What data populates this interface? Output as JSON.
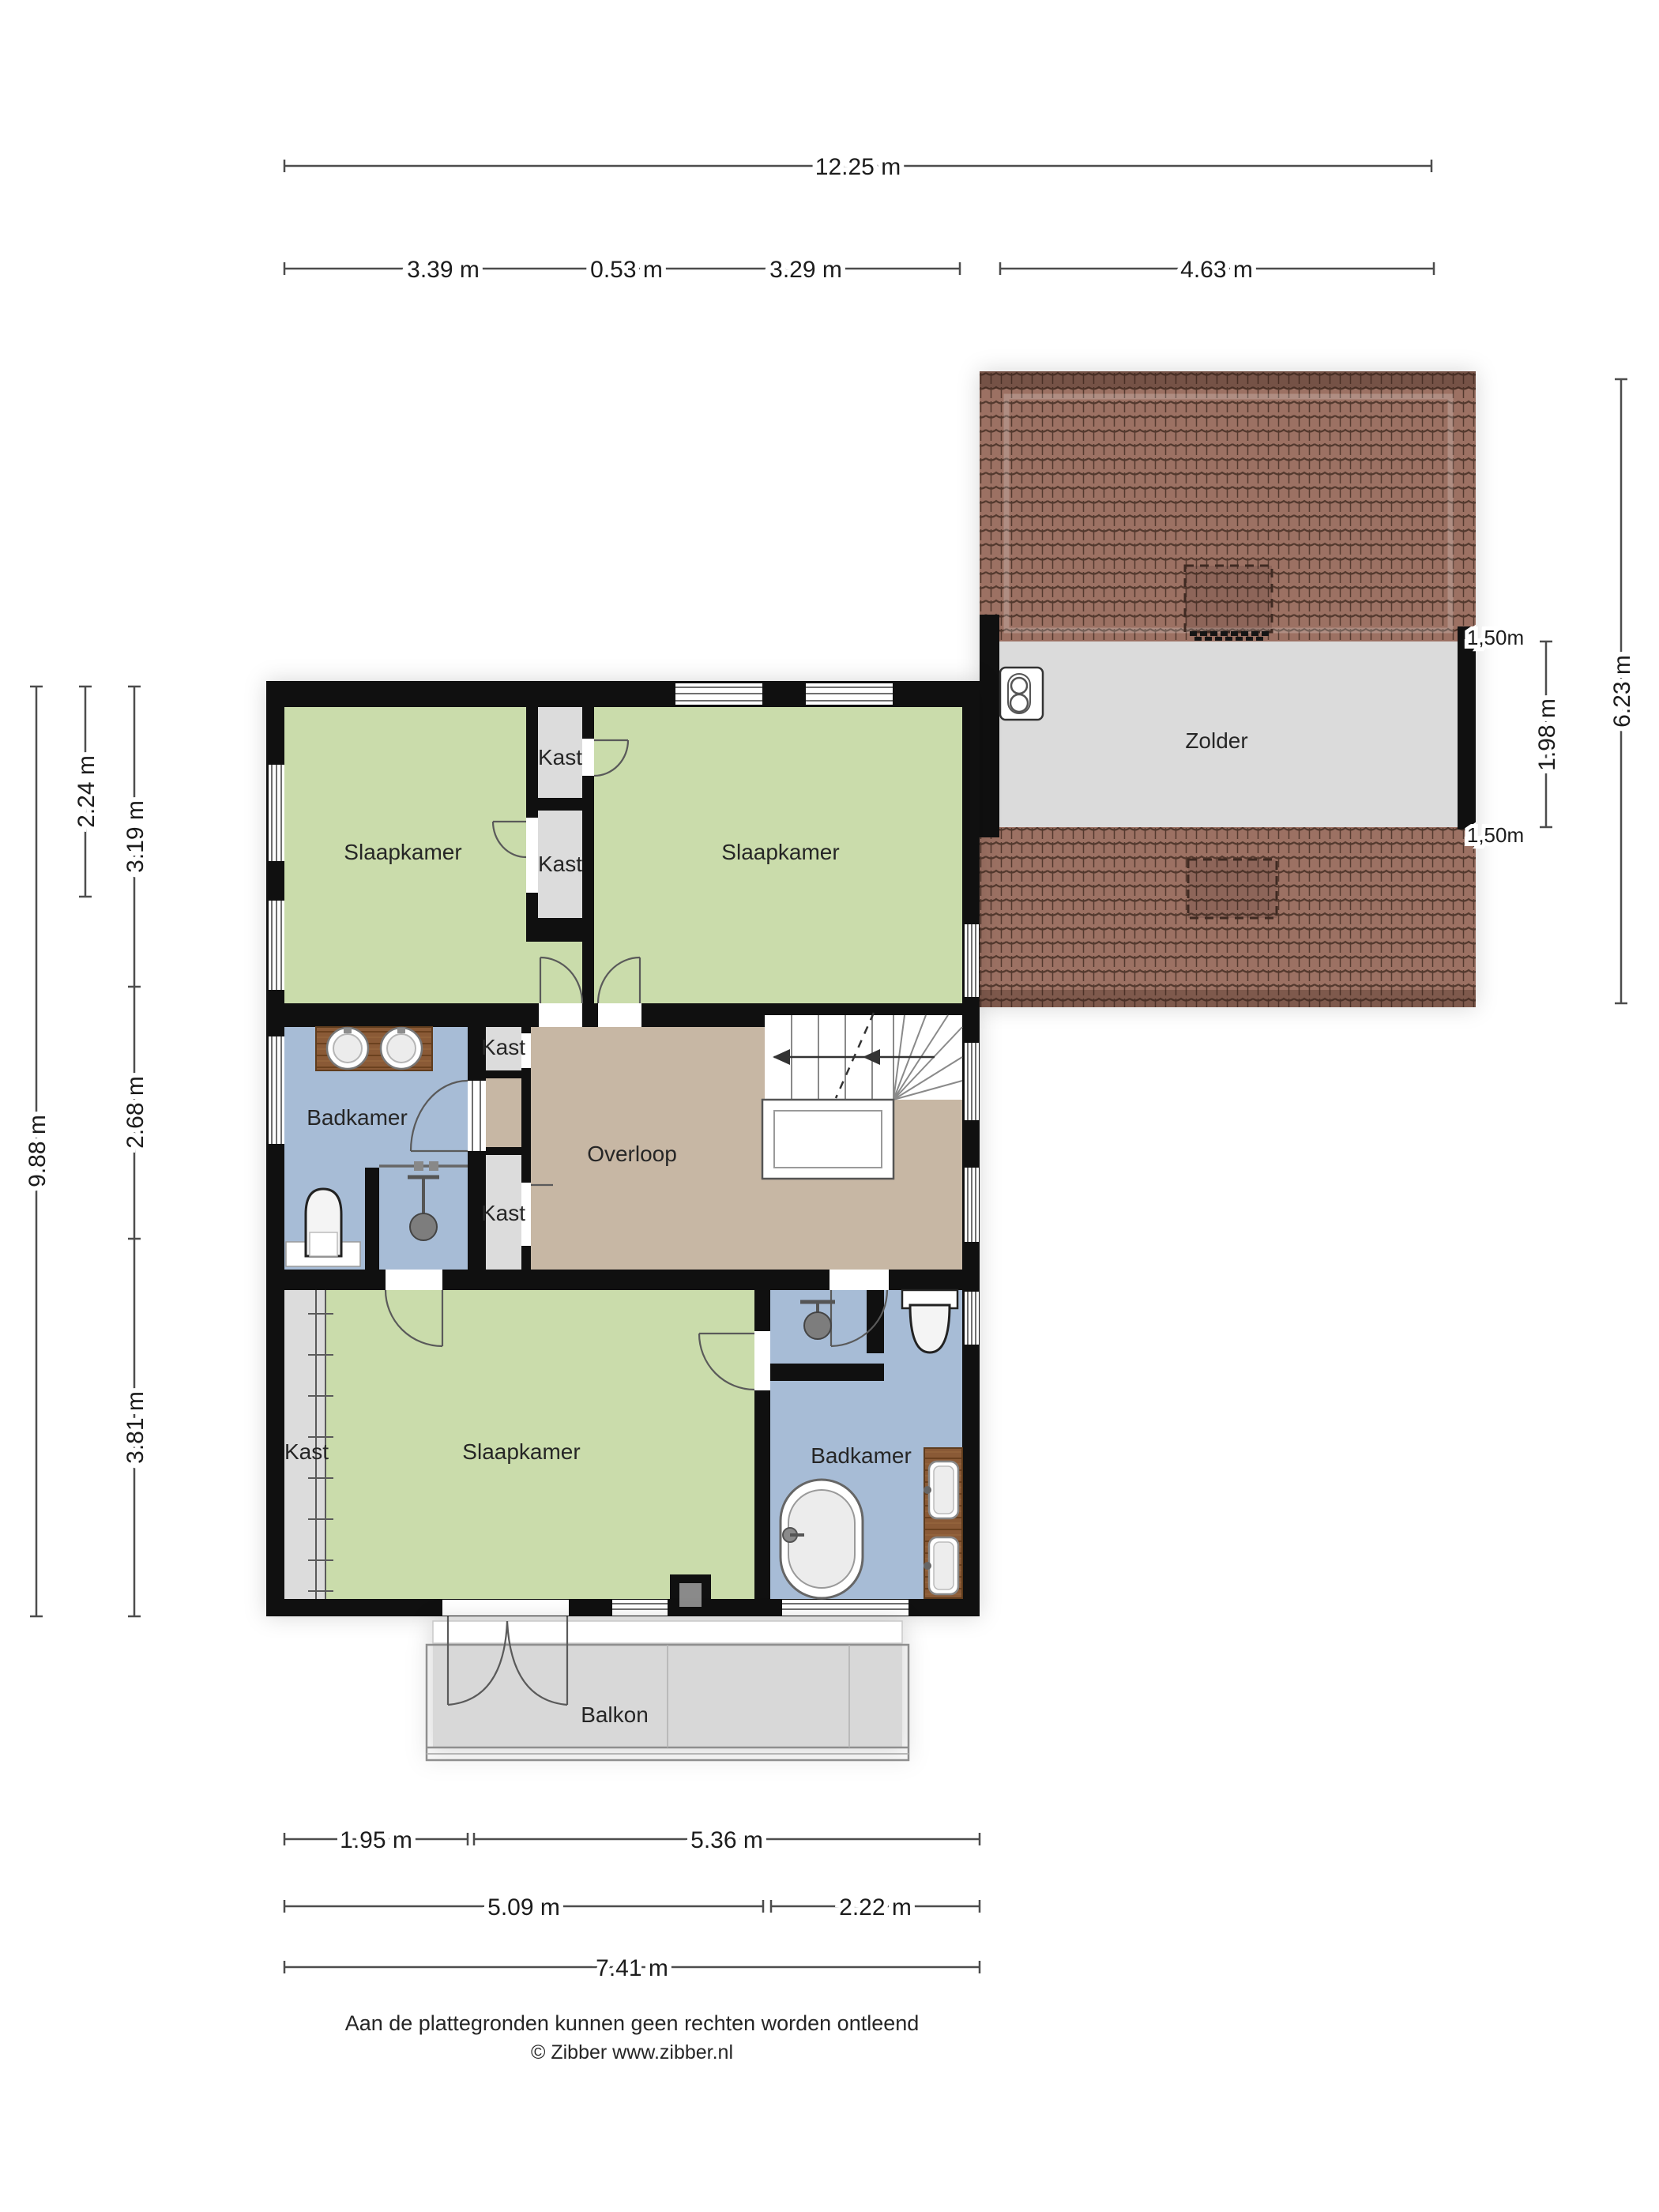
{
  "document": {
    "type": "floorplan",
    "language": "nl",
    "footer_disclaimer": "Aan de plattegronden kunnen geen rechten worden ontleend",
    "footer_copyright": "© Zibber www.zibber.nl"
  },
  "rooms": {
    "bedroom_nw": "Slaapkamer",
    "bedroom_ne": "Slaapkamer",
    "bedroom_s": "Slaapkamer",
    "bathroom_mid": "Badkamer",
    "bathroom_s": "Badkamer",
    "landing": "Overloop",
    "attic": "Zolder",
    "balcony": "Balkon",
    "closet_top_upper": "Kast",
    "closet_top_lower": "Kast",
    "closet_mid_upper": "Kast",
    "closet_mid_lower": "Kast",
    "closet_s": "Kast"
  },
  "dimensions": {
    "top_total": "12.25 m",
    "top_seg_1": "3.39 m",
    "top_seg_2": "0.53 m",
    "top_seg_3": "3.29 m",
    "top_seg_4": "4.63 m",
    "left_total": "9.88 m",
    "left_window": "2.24 m",
    "left_seg_1": "3.19 m",
    "left_seg_2": "2.68 m",
    "left_seg_3": "3.81 m",
    "right_total": "6.23 m",
    "right_attic_floor": "1.98 m",
    "knee_wall_top": "1,50m",
    "knee_wall_bottom": "1,50m",
    "bottom_r1_seg1": "1.95 m",
    "bottom_r1_seg2": "5.36 m",
    "bottom_r2_seg1": "5.09 m",
    "bottom_r2_seg2": "2.22 m",
    "bottom_total": "7.41 m"
  },
  "colors": {
    "wall": "#101010",
    "bedroom": "#cadcab",
    "bathroom": "#a7bcd6",
    "landing": "#c7b7a4",
    "closet": "#dcdcdc",
    "attic_floor": "#dbdbdb",
    "balcony": "#d8d8d8",
    "roof_tile": "#9c7163",
    "roof_line": "#53392e",
    "wood": "#8a5a36"
  }
}
